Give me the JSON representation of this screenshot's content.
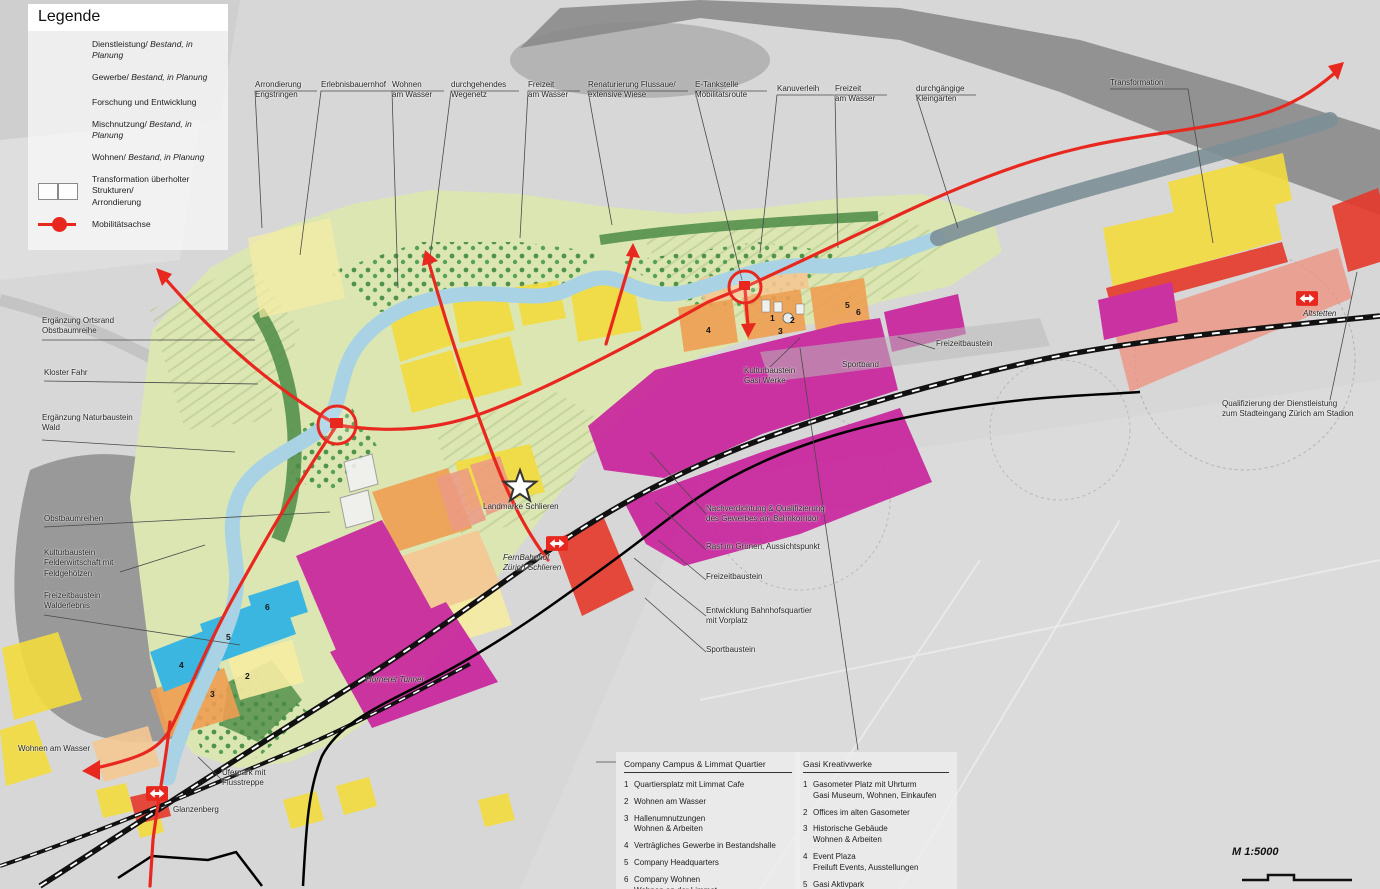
{
  "palette": {
    "red": "#e6392b",
    "red_light": "#ef9180",
    "magenta": "#c9219c",
    "magenta_light": "#d879bd",
    "cyan": "#29b1e6",
    "orange": "#ef9f52",
    "orange_light": "#f6c893",
    "yellow": "#f3dc3e",
    "yellow_light": "#f8eda3",
    "mobility_red": "#e8281e",
    "river": "#a9d3e4",
    "green_light": "#dbe6b3",
    "green_dark": "#4c8b46"
  },
  "legend": {
    "title": "Legende",
    "items": [
      {
        "label": "Dienstleistung/",
        "italic": "Bestand, in Planung"
      },
      {
        "label": "Gewerbe/",
        "italic": "Bestand, in Planung"
      },
      {
        "label": "Forschung und Entwicklung",
        "italic": ""
      },
      {
        "label": "Mischnutzung/",
        "italic": "Bestand, in Planung"
      },
      {
        "label": "Wohnen/",
        "italic": "Bestand, in Planung"
      },
      {
        "label": "Transformation überholter Strukturen/\nArrondierung",
        "italic": ""
      },
      {
        "label": "Mobilitätsachse",
        "italic": ""
      }
    ]
  },
  "top_labels": [
    {
      "text": "Arrondierung\nEngstringen"
    },
    {
      "text": "Erlebnisbauernhof"
    },
    {
      "text": "Wohnen\nam Wasser"
    },
    {
      "text": "durchgehendes\nWegenetz"
    },
    {
      "text": "Freizeit\nam Wasser"
    },
    {
      "text": "Renaturierung Flussaue/\nextensive Wiese"
    },
    {
      "text": "E-Tankstelle\nMobilitätsroute"
    },
    {
      "text": "Kanuverleih"
    },
    {
      "text": "Freizeit\nam Wasser"
    },
    {
      "text": "durchgängige\nKleingärten"
    },
    {
      "text": "Transformation"
    }
  ],
  "map_labels": [
    {
      "text": "Ergänzung Ortsrand\nObstbaumreihe"
    },
    {
      "text": "Kloster Fahr"
    },
    {
      "text": "Ergänzung Naturbaustein\nWald"
    },
    {
      "text": "Obstbaumreihen"
    },
    {
      "text": "Kulturbaustein\nFelderwirtschaft mit\nFeldgehölzen"
    },
    {
      "text": "Freizeitbaustein\nWalderlebnis"
    },
    {
      "text": "Wohnen am Wasser"
    },
    {
      "text": "Uferpark mit\nFlusstreppe"
    },
    {
      "text": "Glanzenberg"
    },
    {
      "text": "Freizeitbaustein"
    },
    {
      "text": "Sportband"
    },
    {
      "text": "Kulturbaustein\nGasi Werke"
    },
    {
      "text": "Altstetten"
    },
    {
      "text": "Qualifizierung der Dienstleistung\nzum Stadteingang Zürich am Stadion"
    },
    {
      "text": "Landmarke Schlieren"
    },
    {
      "text": "FernBahnhof\nZürich-Schlieren"
    },
    {
      "text": "Nachverdichtung & Qualifizierung\ndes Gewerbes am Bahnkorridor"
    },
    {
      "text": "Rast im Grünen, Aussichtspunkt"
    },
    {
      "text": "Freizeitbaustein"
    },
    {
      "text": "Entwicklung Bahnhofsquartier\nmit Vorplatz"
    },
    {
      "text": "Sportbaustein"
    },
    {
      "text": "Horneret Tunnel"
    }
  ],
  "boxes": [
    {
      "title": "Company Campus & Limmat Quartier",
      "items": [
        {
          "n": "1",
          "t": "Quartiersplatz mit Limmat Cafe"
        },
        {
          "n": "2",
          "t": "Wohnen am Wasser"
        },
        {
          "n": "3",
          "t": "Hallenumnutzungen\nWohnen & Arbeiten"
        },
        {
          "n": "4",
          "t": "Verträgliches Gewerbe in Bestandshalle"
        },
        {
          "n": "5",
          "t": "Company Headquarters"
        },
        {
          "n": "6",
          "t": "Company Wohnen\nWohnen an der Limmat"
        }
      ]
    },
    {
      "title": "Gasi Kreativwerke",
      "items": [
        {
          "n": "1",
          "t": "Gasometer Platz mit Uhrturm\nGasi Museum, Wohnen, Einkaufen"
        },
        {
          "n": "2",
          "t": "Offices im alten Gasometer"
        },
        {
          "n": "3",
          "t": "Historische Gebäude\nWohnen & Arbeiten"
        },
        {
          "n": "4",
          "t": "Event Plaza\nFreiluft Events, Ausstellungen"
        },
        {
          "n": "5",
          "t": "Gasi Aktivpark"
        },
        {
          "n": "6",
          "t": "Optionsfläche Inszenierung\nGastanks"
        }
      ]
    }
  ],
  "parcel_numbers": [
    {
      "n": "6"
    },
    {
      "n": "5"
    },
    {
      "n": "4"
    },
    {
      "n": "2"
    },
    {
      "n": "3"
    },
    {
      "n": "4"
    },
    {
      "n": "1"
    },
    {
      "n": "2"
    },
    {
      "n": "3"
    },
    {
      "n": "5"
    },
    {
      "n": "6"
    }
  ],
  "scale": {
    "label": "M 1:5000"
  }
}
